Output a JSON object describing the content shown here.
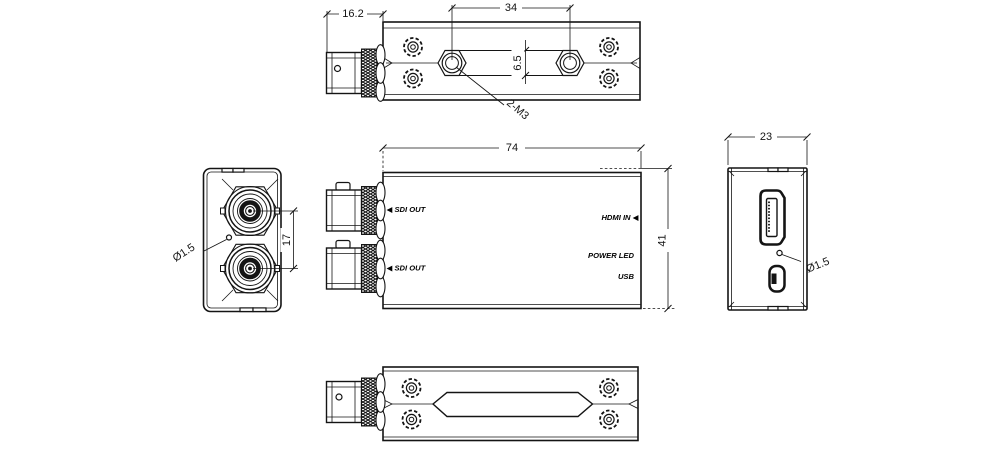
{
  "colors": {
    "line": "#141414",
    "background": "#ffffff"
  },
  "top_view": {
    "dim_connector_length": "16.2",
    "dim_standoff_spacing": "34",
    "dim_boss_width": "6.5",
    "thread_callout": "2-M3"
  },
  "left_view": {
    "hole_callout": "Ø1.5",
    "dim_bnc_spacing": "17"
  },
  "front_view": {
    "dim_length": "74",
    "dim_height": "41",
    "sdi_out_top": "◀ SDI OUT",
    "sdi_out_bottom": "◀ SDI OUT",
    "hdmi_in": "HDMI IN ◀",
    "power_led": "POWER LED",
    "usb": "USB"
  },
  "right_view": {
    "dim_width": "23",
    "hole_callout": "Ø1.5"
  }
}
